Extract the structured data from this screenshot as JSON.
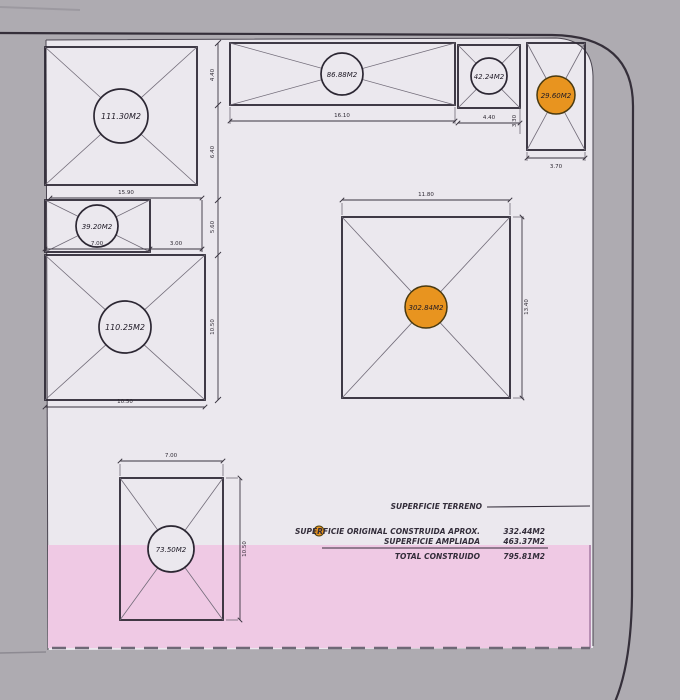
{
  "plan": {
    "rooms": [
      {
        "id": "room-a",
        "area": "111.30M2",
        "highlighted": false
      },
      {
        "id": "room-b",
        "area": "86.88M2",
        "highlighted": false
      },
      {
        "id": "room-c",
        "area": "42.24M2",
        "highlighted": false
      },
      {
        "id": "room-d",
        "area": "29.60M2",
        "highlighted": true
      },
      {
        "id": "room-e",
        "area": "39.20M2",
        "highlighted": false
      },
      {
        "id": "room-f",
        "area": "110.25M2",
        "highlighted": false
      },
      {
        "id": "room-g",
        "area": "302.84M2",
        "highlighted": true
      },
      {
        "id": "room-h",
        "area": "73.50M2",
        "highlighted": false
      }
    ],
    "dimensions": {
      "b_width": "16.10",
      "c_width": "4.40",
      "d_width": "3.70",
      "d_height": "3.30",
      "a_width": "15.90",
      "e_width": "7.00",
      "e_extension": "3.00",
      "f_width": "10.50",
      "g_width": "11.80",
      "g_height": "13.40",
      "h_width": "7.00",
      "h_height": "10.50",
      "chain_1": "4.40",
      "chain_2": "6.40",
      "chain_3": "5.60",
      "chain_4": "10.50"
    }
  },
  "legend": {
    "terreno_label": "SUPERFICIE TERRENO",
    "original_label": "SUPERFICIE ORIGINAL CONSTRUIDA  APROX.",
    "original_value": "332.44M2",
    "ampliada_label": "SUPERFICIE AMPLIADA",
    "ampliada_value": "463.37M2",
    "total_label": "TOTAL CONSTRUIDO",
    "total_value": "795.81M2"
  },
  "colors": {
    "highlight_orange": "#e8941f",
    "ampliada_pink": "#efc9e4",
    "paper": "#ebe8ee",
    "background": "#aeabb1",
    "ink": "#2c2733"
  }
}
